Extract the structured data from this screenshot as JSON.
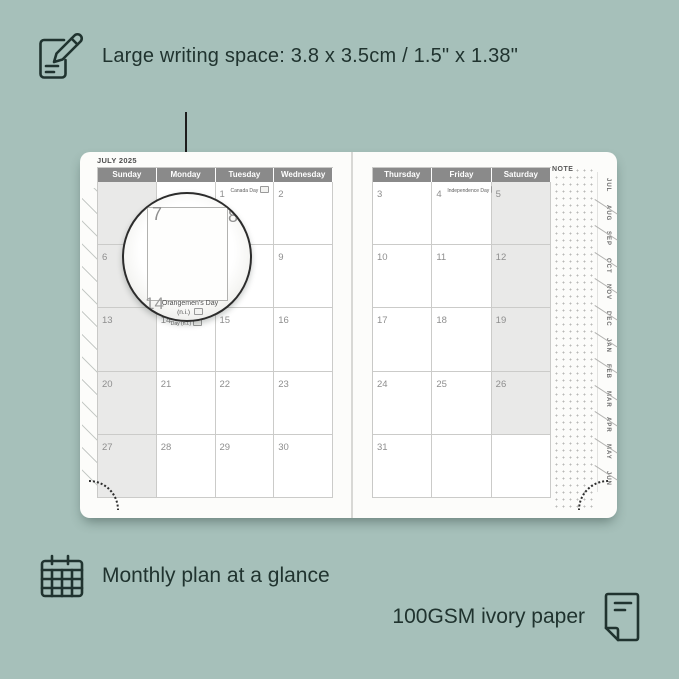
{
  "colors": {
    "background": "#a6c0ba",
    "annotation_text": "#20332f",
    "page": "#fcfcfa",
    "header_bg": "#8a8a8a",
    "header_text": "#ffffff",
    "shaded_cell": "#e9e9e8",
    "day_number": "#8e8e8e"
  },
  "top_annotation": {
    "icon": "notepad-pencil-icon",
    "text": "Large writing space: 3.8 x 3.5cm / 1.5\" x 1.38\""
  },
  "bottom_annotations": {
    "monthly_icon": "calendar-grid-icon",
    "monthly_text": "Monthly plan at a glance",
    "paper_text": "100GSM ivory paper",
    "paper_icon": "paper-sheet-icon"
  },
  "planner": {
    "month_title": "JULY 2025",
    "note_label": "NOTE",
    "left_page": {
      "day_headers": [
        "Sunday",
        "Monday",
        "Tuesday",
        "Wednesday"
      ],
      "weeks": [
        [
          {
            "day": "",
            "shaded": true
          },
          {
            "day": ""
          },
          {
            "day": "1",
            "holiday": "Canada Day",
            "flag": true
          },
          {
            "day": "2"
          }
        ],
        [
          {
            "day": "6",
            "shaded": true
          },
          {
            "day": "7"
          },
          {
            "day": "8"
          },
          {
            "day": "9"
          }
        ],
        [
          {
            "day": "13",
            "shaded": true
          },
          {
            "day": "14",
            "holiday": "Orangemen's Day (n.i.)",
            "flag": true,
            "wrap": true
          },
          {
            "day": "15"
          },
          {
            "day": "16"
          }
        ],
        [
          {
            "day": "20",
            "shaded": true
          },
          {
            "day": "21"
          },
          {
            "day": "22"
          },
          {
            "day": "23"
          }
        ],
        [
          {
            "day": "27",
            "shaded": true
          },
          {
            "day": "28"
          },
          {
            "day": "29"
          },
          {
            "day": "30"
          }
        ]
      ]
    },
    "right_page": {
      "day_headers": [
        "Thursday",
        "Friday",
        "Saturday"
      ],
      "weeks": [
        [
          {
            "day": "3"
          },
          {
            "day": "4",
            "holiday": "Independence Day",
            "flag": true
          },
          {
            "day": "5",
            "shaded": true
          }
        ],
        [
          {
            "day": "10"
          },
          {
            "day": "11"
          },
          {
            "day": "12",
            "shaded": true
          }
        ],
        [
          {
            "day": "17"
          },
          {
            "day": "18"
          },
          {
            "day": "19",
            "shaded": true
          }
        ],
        [
          {
            "day": "24"
          },
          {
            "day": "25"
          },
          {
            "day": "26",
            "shaded": true
          }
        ],
        [
          {
            "day": "31"
          },
          {
            "day": ""
          },
          {
            "day": ""
          }
        ]
      ]
    },
    "month_tabs": [
      "JUL",
      "AUG",
      "SEP",
      "OCT",
      "NOV",
      "DEC",
      "JAN",
      "FEB",
      "MAR",
      "APR",
      "MAY",
      "JUN"
    ],
    "magnifier": {
      "day_top_left": "7",
      "day_top_right": "8",
      "day_bottom": "14",
      "holiday_line1": "Orangemen's Day",
      "holiday_line2": "(n.i.)"
    }
  }
}
